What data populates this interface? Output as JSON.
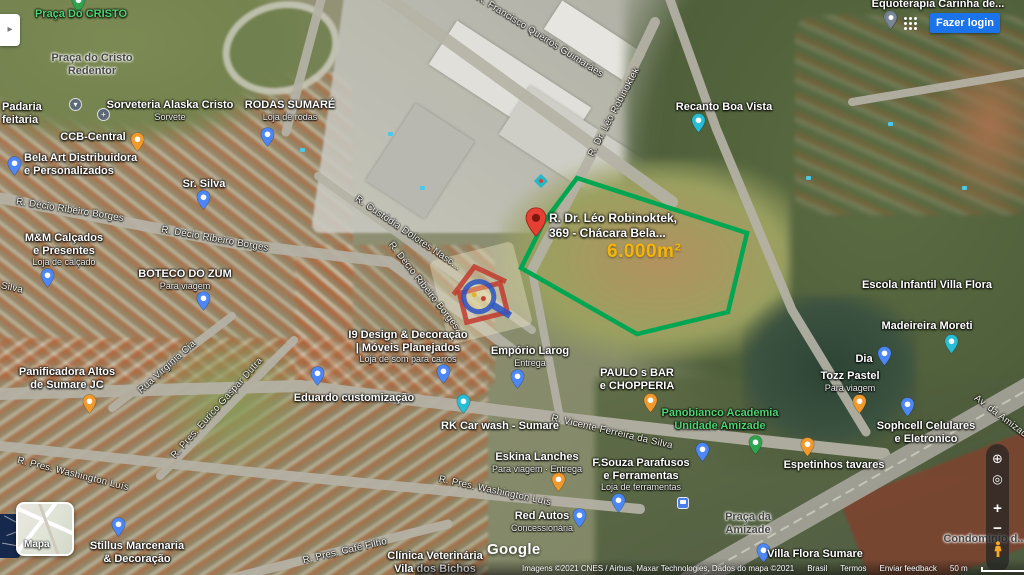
{
  "ui": {
    "top_right": {
      "signin": "Fazer login"
    },
    "icons": {
      "globe": "⊕",
      "locate": "◎",
      "zoom_in": "+",
      "zoom_out": "−",
      "panel_arrow": "▸",
      "bar": "▾",
      "church": "+"
    },
    "map_toggle": {
      "label": "Mapa"
    },
    "google_logo": "Google",
    "attribution": {
      "imagery": "Imagens ©2021 CNES / Airbus, Maxar Technologies, Dados do mapa ©2021",
      "links": [
        "Brasil",
        "Termos",
        "Enviar feedback"
      ],
      "scale_label": "50 m"
    }
  },
  "parcel": {
    "area_label": "6.000m²",
    "outline_color": "#00a651"
  },
  "marker": {
    "line1": "R. Dr. Léo Robinoktek,",
    "line2": "369 - Chácara Bela..."
  },
  "pin_colors": {
    "blue": "#4d87f5",
    "food": "#f09a2d",
    "teal": "#27bdd4",
    "green": "#2fa44f",
    "gray": "#8795a1",
    "red": "#e84335"
  },
  "pois": [
    {
      "lines": [
        "Praça Do CRISTO"
      ],
      "color": "green",
      "x": 81,
      "y": 8,
      "pin": {
        "type": "green",
        "x": 78,
        "y": 13
      }
    },
    {
      "lines": [
        "Sorveteria Alaska Cristo"
      ],
      "sub": "Sorvete",
      "x": 170,
      "y": 99,
      "pin": {
        "type": "food",
        "x": 137,
        "y": 152
      }
    },
    {
      "lines": [
        "RODAS SUMARÉ"
      ],
      "sub": "Loja de rodas",
      "x": 290,
      "y": 99,
      "pin": {
        "type": "blue",
        "x": 267,
        "y": 147
      }
    },
    {
      "lines": [
        "CCB-Central"
      ],
      "x": 93,
      "y": 131
    },
    {
      "lines": [
        "Padaria",
        "feitaria"
      ],
      "x": 2,
      "y": 101,
      "align": "left"
    },
    {
      "lines": [
        "Bela Art Distribuidora",
        "e Personalizados"
      ],
      "x": 24,
      "y": 152,
      "align": "left",
      "pin": {
        "type": "blue",
        "x": 14,
        "y": 176
      }
    },
    {
      "lines": [
        "Sr. Silva"
      ],
      "x": 204,
      "y": 178,
      "pin": {
        "type": "blue",
        "x": 203,
        "y": 210
      }
    },
    {
      "lines": [
        "M&M Calçados",
        "e Presentes"
      ],
      "sub": "Loja de calçado",
      "x": 64,
      "y": 232,
      "pin": {
        "type": "blue",
        "x": 47,
        "y": 288
      }
    },
    {
      "lines": [
        "BOTECO DO ZUM"
      ],
      "sub": "Para viagem",
      "x": 185,
      "y": 268,
      "pin": {
        "type": "blue",
        "x": 203,
        "y": 311
      }
    },
    {
      "lines": [
        "Panificadora Altos",
        "de Sumare JC"
      ],
      "x": 67,
      "y": 366,
      "pin": {
        "type": "food",
        "x": 89,
        "y": 414
      }
    },
    {
      "lines": [
        "Eduardo customização"
      ],
      "x": 354,
      "y": 392,
      "pin": {
        "type": "blue",
        "x": 317,
        "y": 386
      }
    },
    {
      "lines": [
        "I9 Design & Decoração",
        "| Móveis Planejados"
      ],
      "sub": "Loja de som para carros",
      "x": 408,
      "y": 329,
      "pin": {
        "type": "blue",
        "x": 443,
        "y": 384
      }
    },
    {
      "lines": [
        "Empório Larog"
      ],
      "sub": "Entrega",
      "x": 530,
      "y": 345,
      "pin": {
        "type": "blue",
        "x": 517,
        "y": 389
      }
    },
    {
      "lines": [
        "RK Car wash - Sumare"
      ],
      "x": 500,
      "y": 420,
      "pin": {
        "type": "teal",
        "x": 463,
        "y": 414
      }
    },
    {
      "lines": [
        "PAULO s BAR",
        "e CHOPPERIA"
      ],
      "x": 637,
      "y": 367,
      "pin": {
        "type": "food",
        "x": 650,
        "y": 413
      }
    },
    {
      "lines": [
        "Panobianco Academia",
        "Unidade Amizade"
      ],
      "color": "green",
      "x": 720,
      "y": 407,
      "pin": {
        "type": "green",
        "x": 755,
        "y": 455
      }
    },
    {
      "lines": [
        "Espetinhos tavares"
      ],
      "x": 834,
      "y": 459,
      "pin": {
        "type": "food",
        "x": 807,
        "y": 457
      }
    },
    {
      "lines": [
        "Eskina Lanches"
      ],
      "sub": "Para viagem · Entrega",
      "x": 537,
      "y": 451,
      "pin": {
        "type": "food",
        "x": 558,
        "y": 492
      }
    },
    {
      "lines": [
        "F.Souza Parafusos",
        "e Ferramentas"
      ],
      "sub": "Loja de ferramentas",
      "x": 641,
      "y": 457,
      "pin": {
        "type": "blue",
        "x": 618,
        "y": 513
      }
    },
    {
      "lines": [
        "Red Autos"
      ],
      "sub": "Concessionária",
      "x": 542,
      "y": 510,
      "pin": {
        "type": "blue",
        "x": 579,
        "y": 528
      }
    },
    {
      "lines": [
        "Stillus Marcenaria",
        "& Decoração"
      ],
      "x": 137,
      "y": 540,
      "pin": {
        "type": "blue",
        "x": 118,
        "y": 537
      }
    },
    {
      "lines": [
        "Clínica Veterinária",
        "Vila dos Bichos"
      ],
      "x": 435,
      "y": 550
    },
    {
      "lines": [
        "Sophcell Celulares",
        "e Eletronico"
      ],
      "x": 926,
      "y": 420,
      "pin": {
        "type": "blue",
        "x": 907,
        "y": 417
      }
    },
    {
      "lines": [
        "Madeireira Moreti"
      ],
      "x": 927,
      "y": 320,
      "pin": {
        "type": "teal",
        "x": 951,
        "y": 354
      }
    },
    {
      "lines": [
        "Dia"
      ],
      "x": 864,
      "y": 353,
      "pin": {
        "type": "blue",
        "x": 884,
        "y": 366
      }
    },
    {
      "lines": [
        "Tozz Pastel"
      ],
      "sub": "Para viagem",
      "x": 850,
      "y": 370,
      "pin": {
        "type": "food",
        "x": 859,
        "y": 414
      }
    },
    {
      "lines": [
        "Escola Infantil Villa Flora"
      ],
      "x": 927,
      "y": 279
    },
    {
      "lines": [
        "Recanto Boa Vista"
      ],
      "x": 724,
      "y": 101,
      "pin": {
        "type": "teal",
        "x": 698,
        "y": 133
      }
    },
    {
      "lines": [
        "Villa Flora Sumare"
      ],
      "x": 815,
      "y": 548,
      "pin": {
        "type": "blue",
        "x": 763,
        "y": 563
      }
    },
    {
      "lines": [
        "Equoterapia Carinha de..."
      ],
      "x": 938,
      "y": -2,
      "pin": {
        "type": "gray",
        "x": 890,
        "y": 30
      }
    }
  ],
  "streets": [
    {
      "name": "R. Décio Ribeiro Borges",
      "x": 70,
      "y": 210,
      "angle": 9
    },
    {
      "name": "R. Décio Ribeiro Borges",
      "x": 215,
      "y": 239,
      "angle": 10
    },
    {
      "name": "R. Décio Ribeiro Borges",
      "x": 424,
      "y": 286,
      "angle": 52
    },
    {
      "name": "R. Custódia Dolores Nasc...",
      "x": 408,
      "y": 233,
      "angle": 34
    },
    {
      "name": "R. Francisco Queirós Guimarães",
      "x": 540,
      "y": 36,
      "angle": 32
    },
    {
      "name": "R. Dr. Léo Robinoktek",
      "x": 614,
      "y": 112,
      "angle": -62
    },
    {
      "name": "Rua Virgínia Cia",
      "x": 167,
      "y": 367,
      "angle": -42
    },
    {
      "name": "R. Pres. Eurico Gaspar Dutra",
      "x": 217,
      "y": 408,
      "angle": -48
    },
    {
      "name": "R. Vicente Ferreira da Silva",
      "x": 612,
      "y": 432,
      "angle": 13
    },
    {
      "name": "R. Pres. Washington Luís",
      "x": 73,
      "y": 474,
      "angle": 14
    },
    {
      "name": "R. Pres. Washington Luís",
      "x": 495,
      "y": 491,
      "angle": 12
    },
    {
      "name": "R. Pres. Café Filho",
      "x": 345,
      "y": 551,
      "angle": -13
    },
    {
      "name": "Av. da Amizade",
      "x": 1003,
      "y": 418,
      "angle": 37
    },
    {
      "name": "Silva",
      "x": 12,
      "y": 288,
      "angle": 12
    }
  ],
  "areas": [
    {
      "lines": [
        "Praça do Cristo",
        "Redentor"
      ],
      "x": 92,
      "y": 52
    },
    {
      "lines": [
        "Praça da",
        "Amizade"
      ],
      "x": 748,
      "y": 511
    },
    {
      "lines": [
        "Condomínio d..."
      ],
      "x": 985,
      "y": 533
    }
  ],
  "misc_markers": [
    {
      "kind": "circle",
      "icon": "bar",
      "x": 75,
      "y": 104
    },
    {
      "kind": "circle",
      "icon": "church",
      "x": 103,
      "y": 114
    },
    {
      "kind": "pin",
      "type": "blue",
      "x": 702,
      "y": 462
    }
  ]
}
